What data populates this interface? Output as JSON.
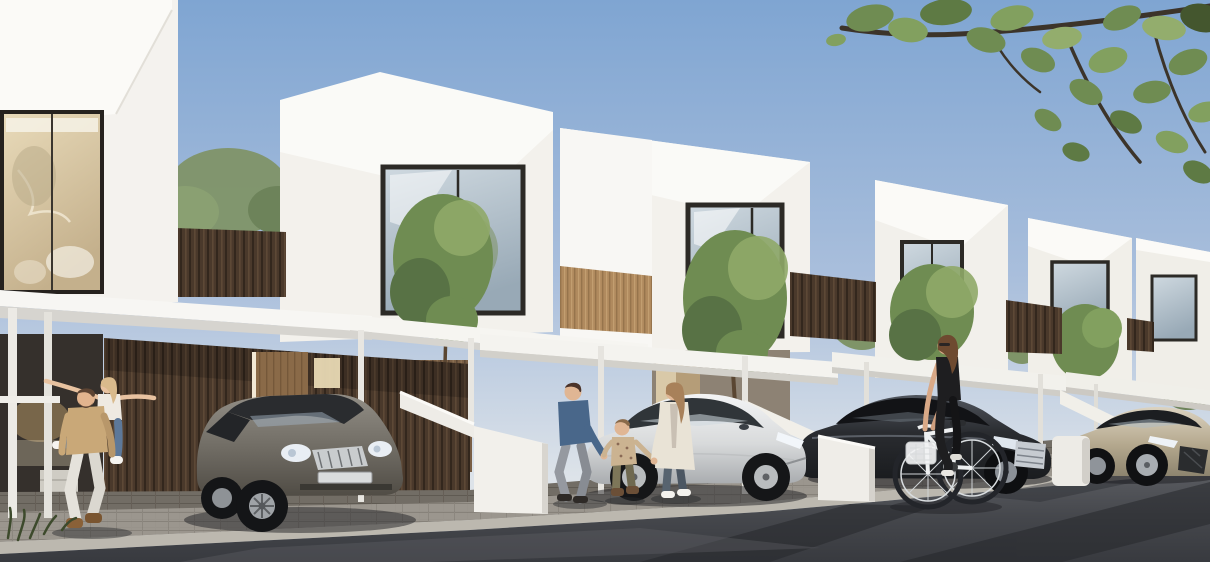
{
  "meta": {
    "kind": "architectural-render",
    "description": "Sunny daytime street view of a receding row of modern two-storey white cube townhouses with cantilevered white carport canopies, timber slat walls, courtyard trees, four parked sedans, a father giving his daughter a piggyback ride, parents walking with a young boy, and a woman riding a white bicycle; leafy branches overhang the top-right corner."
  },
  "scene": {
    "sky": "clear pale-blue sky, lighter toward the horizon",
    "houses": [
      {
        "id": 1,
        "position": "far left, closest",
        "features": "double-height glazed facade with warm lit interior, white canopy on slim posts, dark timber slat carport wall, timber entry door"
      },
      {
        "id": 2,
        "position": "left-centre",
        "features": "white cube with large dark-framed window, courtyard tree, white external stair parapet"
      },
      {
        "id": 3,
        "position": "centre",
        "features": "white cube with tall window, tree in front, carport canopy, open lit doorway"
      },
      {
        "id": 4,
        "position": "right-centre",
        "features": "white cube, window with tree, timber fence band, canopy"
      },
      {
        "id": 5,
        "position": "right",
        "features": "smaller receding white cube with window and canopy"
      },
      {
        "id": 6,
        "position": "far right edge",
        "features": "partially visible white cube"
      }
    ],
    "vehicles": [
      {
        "type": "sedan",
        "color": "warm grey",
        "position": "left carport, nose toward street"
      },
      {
        "type": "electric fastback sedan",
        "color": "silver white",
        "position": "centre carport, facing right"
      },
      {
        "type": "luxury sedan",
        "color": "black",
        "position": "right carport, facing right"
      },
      {
        "type": "sports sedan",
        "color": "champagne",
        "position": "far right, cropped by frame edge"
      }
    ],
    "people": [
      {
        "group": "father in tan t-shirt and white trousers carrying daughter piggyback, her arms spread wide",
        "position": "far-left driveway"
      },
      {
        "group": "father in denim shirt and mother in long cream coat holding hands with young boy",
        "position": "centre, beside silver car"
      },
      {
        "group": "woman in black top and leggings riding white basket bicycle",
        "position": "right, on the road"
      }
    ],
    "vegetation": [
      "courtyard trees between the houses",
      "overhanging leafy branches top right",
      "grass tuft bottom left"
    ],
    "ground": [
      "paved driveway aprons",
      "light stone kerb strip",
      "dark asphalt road with diagonal tree shadows"
    ]
  },
  "colors": {
    "sky_top": "#7fa5d2",
    "sky_mid": "#aabfdc",
    "sky_horizon": "#dde3e9",
    "wall_white": "#f4f2ee",
    "wall_bright": "#fbfaf7",
    "wall_shade": "#e6e3dd",
    "canopy_underside": "#d6d4cf",
    "frame_dark": "#2c2a26",
    "glass_warm_hi": "#e9dbba",
    "glass_warm_lo": "#c4b08c",
    "glass_cool_hi": "#cfd9e0",
    "glass_cool_lo": "#98a9b6",
    "interior_glow": "#e8d9b4",
    "wood_dark": "#4a392b",
    "wood_mid": "#7a5f45",
    "wood_light": "#b08a5e",
    "door_wood": "#8a6a48",
    "foliage_dark": "#526a40",
    "foliage_mid": "#6f8c52",
    "foliage_light": "#8fa868",
    "branch_brown": "#3c342a",
    "trunk_brown": "#5a4632",
    "pavement": "#7b766e",
    "paver_light": "#a29d95",
    "curb": "#bcb8af",
    "asphalt_hi": "#5a5c61",
    "asphalt_mid": "#45474c",
    "asphalt_lo": "#383a3f",
    "shadow": "#1f2023",
    "car_grey_hi": "#928e86",
    "car_grey_lo": "#504c45",
    "car_silver_hi": "#f3f4f5",
    "car_silver_lo": "#a9acaf",
    "car_black_hi": "#51565e",
    "car_black_lo": "#1a1c1f",
    "car_champagne_hi": "#dcd3c0",
    "car_champagne_lo": "#8d846f",
    "chrome": "#c6cbd1",
    "headlight": "#edf2f8",
    "skin": "#e0b694",
    "hair_dark": "#4a332a",
    "hair_blonde": "#d9ba8c",
    "hair_chestnut": "#6e4a30",
    "tee_tan": "#c9a878",
    "pants_white": "#e5e2db",
    "denim_shirt": "#49678a",
    "jeans_blue": "#5d7899",
    "coat_cream": "#e9e3d6",
    "outfit_black": "#1e1e20",
    "bike_white": "#eef0f1",
    "boot_brown": "#8a6138"
  }
}
